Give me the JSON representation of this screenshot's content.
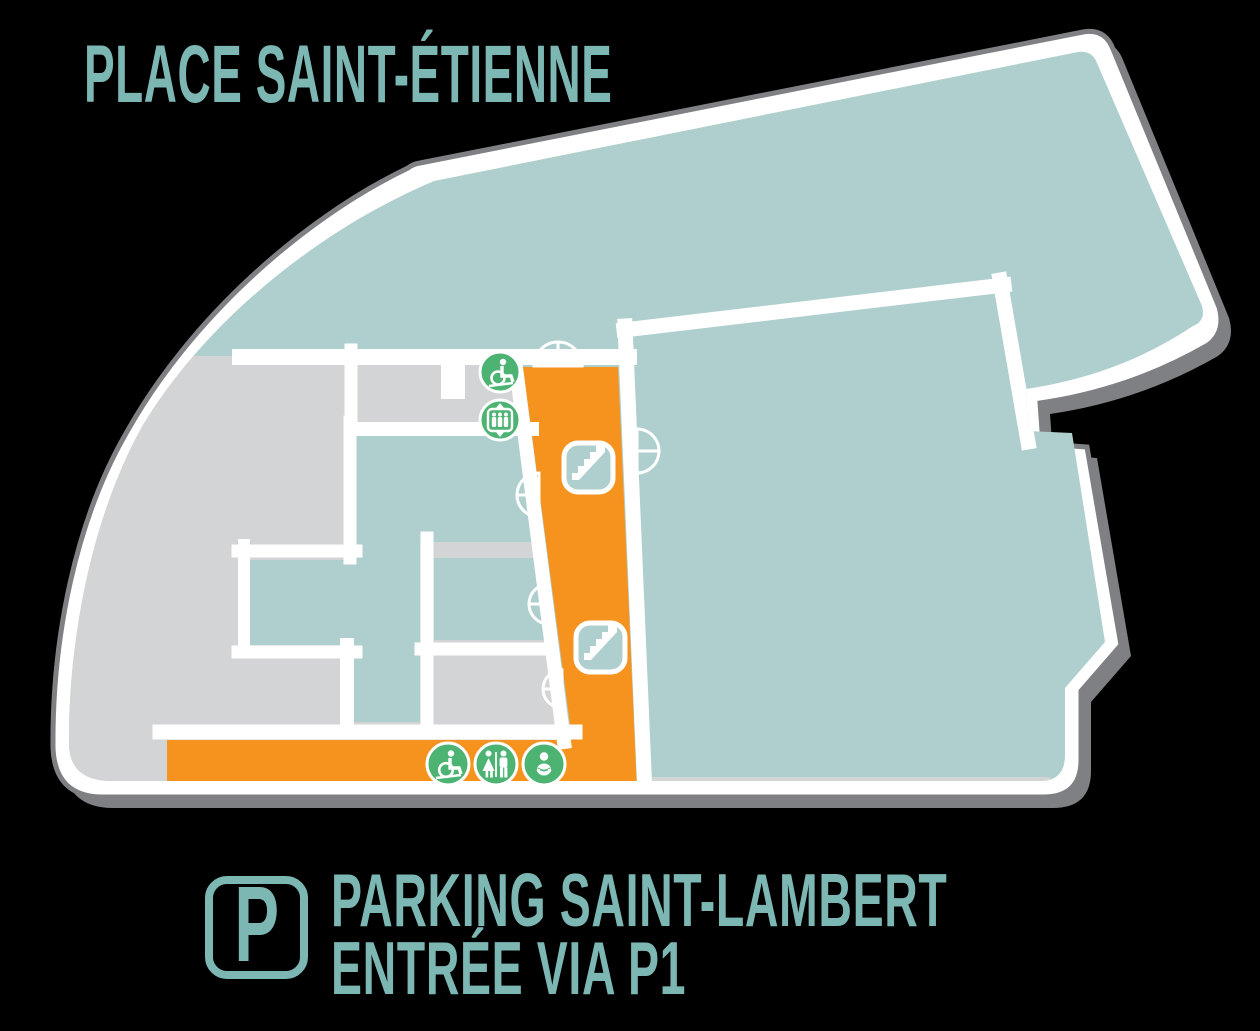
{
  "title": "PLACE SAINT-ÉTIENNE",
  "parking_legend": {
    "badge_letter": "P",
    "line1": "PARKING SAINT-LAMBERT",
    "line2": "ENTRÉE VIA P1"
  },
  "map": {
    "areas": [
      {
        "name": "place-saint-etienne-hall",
        "color_key": "teal"
      },
      {
        "name": "right-hall",
        "color_key": "teal"
      },
      {
        "name": "cross-shaped-room",
        "color_key": "teal"
      },
      {
        "name": "side-room",
        "color_key": "teal"
      },
      {
        "name": "back-of-house-left",
        "color_key": "gray"
      },
      {
        "name": "small-gray-room",
        "color_key": "gray"
      },
      {
        "name": "main-corridor",
        "color_key": "orange"
      }
    ],
    "icons": [
      {
        "name": "wheelchair-access-icon"
      },
      {
        "name": "elevator-icon"
      },
      {
        "name": "stairs-icon-upper"
      },
      {
        "name": "stairs-icon-lower"
      },
      {
        "name": "accessible-toilet-icon"
      },
      {
        "name": "toilets-icon"
      },
      {
        "name": "baby-changing-icon"
      },
      {
        "name": "door-swing-icon",
        "count": 5
      },
      {
        "name": "parking-badge-icon"
      }
    ]
  },
  "colors": {
    "background": "#000000",
    "teal": "#aecfcd",
    "gray": "#d2d4d5",
    "orange": "#f6921e",
    "green": "#4db373",
    "outline": "#7e8083",
    "text_teal": "#7cb7b4",
    "white": "#ffffff"
  }
}
